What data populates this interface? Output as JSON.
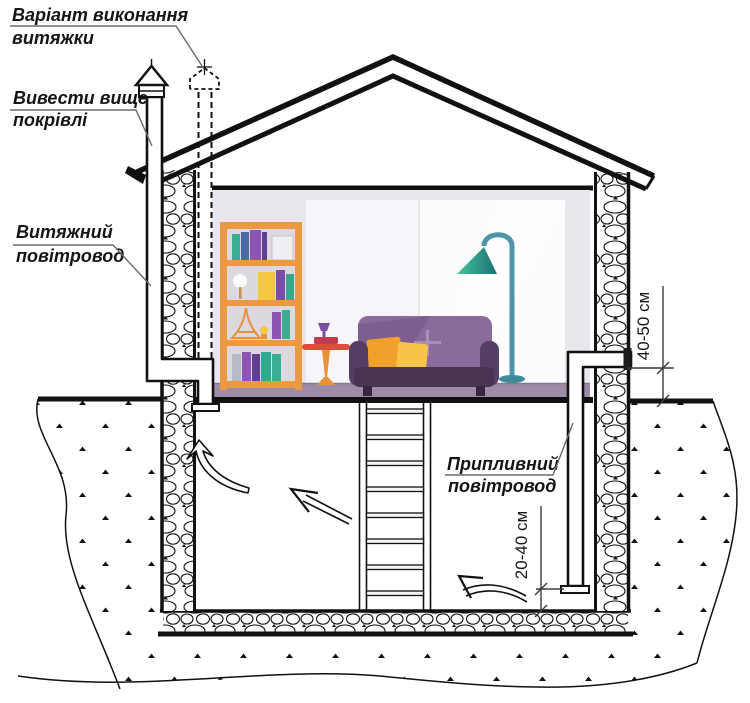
{
  "labels": {
    "variant": {
      "line1": "Варіант виконання",
      "line2": "витяжки"
    },
    "above_roof": {
      "line1": "Вивести вище",
      "line2": "покрівлі"
    },
    "exhaust": {
      "line1": "Витяжний",
      "line2": "повітровод"
    },
    "supply": {
      "line1": "Припливний",
      "line2": "повітровод"
    }
  },
  "dimensions": {
    "intake_above_ground": "40-50 см",
    "outlet_above_floor": "20-40 см"
  },
  "colors": {
    "line": "#111111",
    "leader": "#6b6b6b",
    "room_wall": "#E9E7ED",
    "room_floor": "#9C8BA9",
    "bookshelf": "#EC9A41",
    "sofa": "#8A6B9B",
    "sofa_base": "#4A3454",
    "pillow_orange": "#F1A02D",
    "pillow_yellow": "#F7C34A",
    "lamp_shade": "#41C398",
    "lamp_pole": "#4D96A5",
    "table": "#D9503A"
  }
}
